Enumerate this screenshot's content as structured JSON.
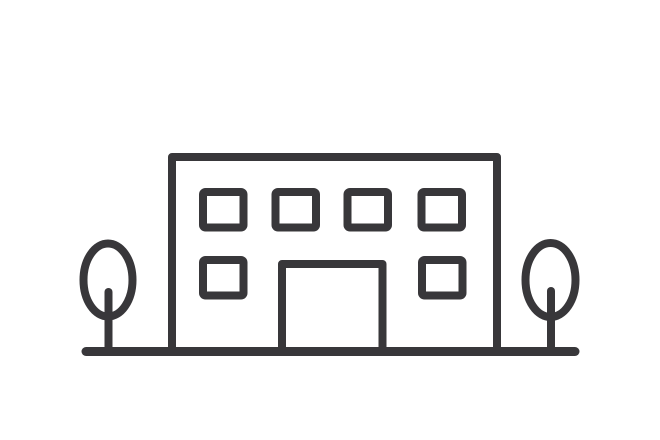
{
  "canvas": {
    "width": "660",
    "height": "440",
    "background_color": "#ffffff"
  },
  "illustration": {
    "icon_name": "office-building-with-trees-icon",
    "style": "outline-line-art",
    "stroke_color": "#38373A",
    "elements": {
      "building": "rectangular two-story building outline",
      "top_row_window_count": "4",
      "bottom_row_window_count": "2",
      "door": "central open-bottom doorway",
      "tree_count": "2",
      "ground": "horizontal ground line with rounded ends"
    }
  }
}
